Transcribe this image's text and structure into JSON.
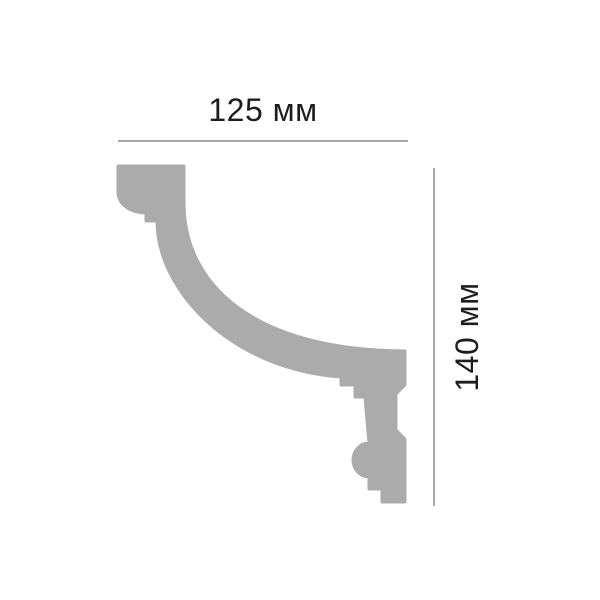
{
  "diagram": {
    "title": "moulding profile cross-section with dimensions",
    "labels": {
      "width": "125 мм",
      "height": "140 мм"
    },
    "values": {
      "width_mm": 125,
      "height_mm": 140,
      "unit": "мм"
    },
    "colors": {
      "background": "#ffffff",
      "profile_fill": "#ababab",
      "dimension_line": "#a6a6a6",
      "label_text": "#1d1d1d"
    }
  }
}
